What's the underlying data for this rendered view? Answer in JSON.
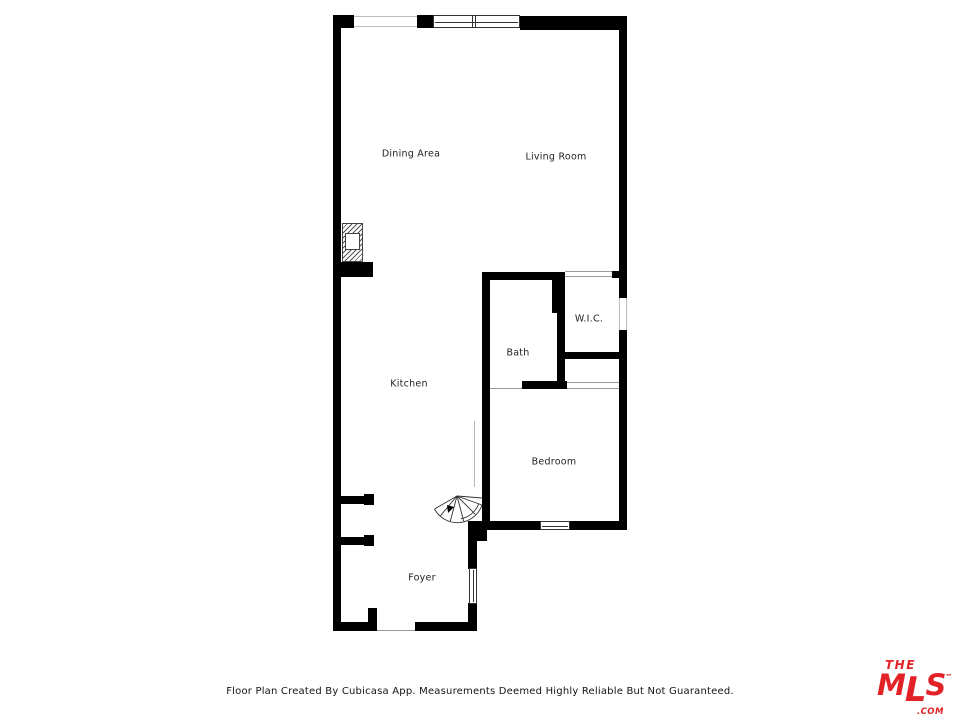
{
  "plan": {
    "rooms": [
      {
        "name": "Dining Area"
      },
      {
        "name": "Living Room"
      },
      {
        "name": "W.I.C."
      },
      {
        "name": "Bath"
      },
      {
        "name": "Kitchen"
      },
      {
        "name": "Bedroom"
      },
      {
        "name": "Foyer"
      }
    ],
    "colors": {
      "wall": "#000000",
      "background": "#ffffff"
    }
  },
  "footer": {
    "disclaimer": "Floor Plan Created By Cubicasa App. Measurements Deemed Highly Reliable But Not Guaranteed."
  },
  "logo": {
    "the": "THE",
    "mls_m": "M",
    "mls_l": "L",
    "mls_s": "S",
    "tm": "™",
    "com": ".COM",
    "brand_color": "#e32228"
  }
}
